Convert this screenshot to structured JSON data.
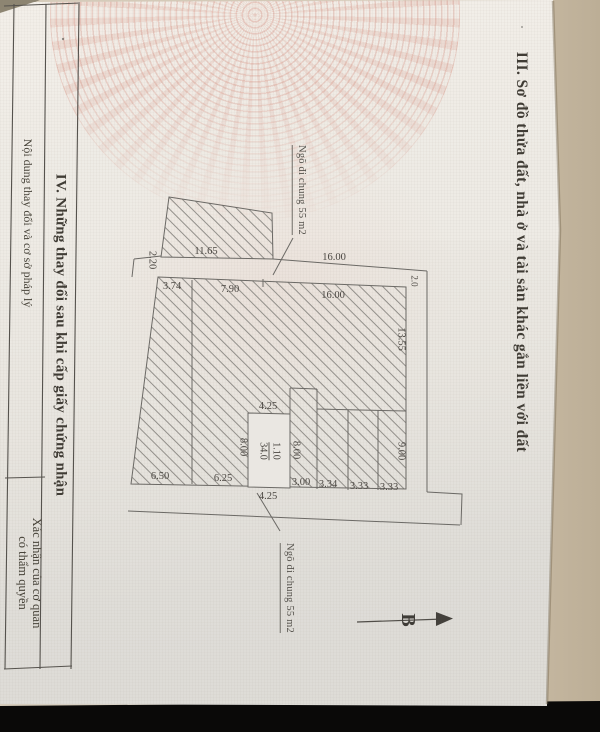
{
  "colors": {
    "backdrop_beige": "#d2c7b4",
    "paper": "#ece9e3",
    "black_band": "#0a0908",
    "line": "#6b6965",
    "emblem_pink": "#d27a69",
    "ink": "#45423e"
  },
  "page": {
    "section3_title": "III. Sơ đồ thửa đất, nhà ở và tài sản khác gắn liền với đất",
    "section4": {
      "title": "IV. Những thay đổi sau khi cấp giấy chứng nhận",
      "col_content": "Nội dung thay đổi và cơ sở pháp lý",
      "col_authority_line1": "Xác nhận của cơ quan",
      "col_authority_line2": "có thẩm quyền"
    }
  },
  "diagram": {
    "alley_top": "Ngõ đi chung 55 m2",
    "alley_bottom": "Ngõ đi chung 55 m2",
    "north": "B",
    "parcel": {
      "number": "1.10",
      "area": "34.0"
    },
    "dims": {
      "top_neighbor": "11.65",
      "alley_left_width": "2.20",
      "alley_top_len": "16.00",
      "top_seg1": "3.74",
      "top_seg2": "7.90",
      "top_seg3": "16.00",
      "right_gap": "2.0",
      "right_seg1": "13.55",
      "right_seg2": "9.00",
      "house_left": "8.00",
      "house_right": "8.00",
      "house_top": "4.25",
      "bottom_seg1": "6.50",
      "bottom_seg2": "6.25",
      "bottom_seg3": "3.00",
      "bottom_seg4": "3.34",
      "bottom_seg5": "3.33",
      "bottom_seg6": "3.33",
      "alley_bottom_len": "4.25"
    }
  }
}
